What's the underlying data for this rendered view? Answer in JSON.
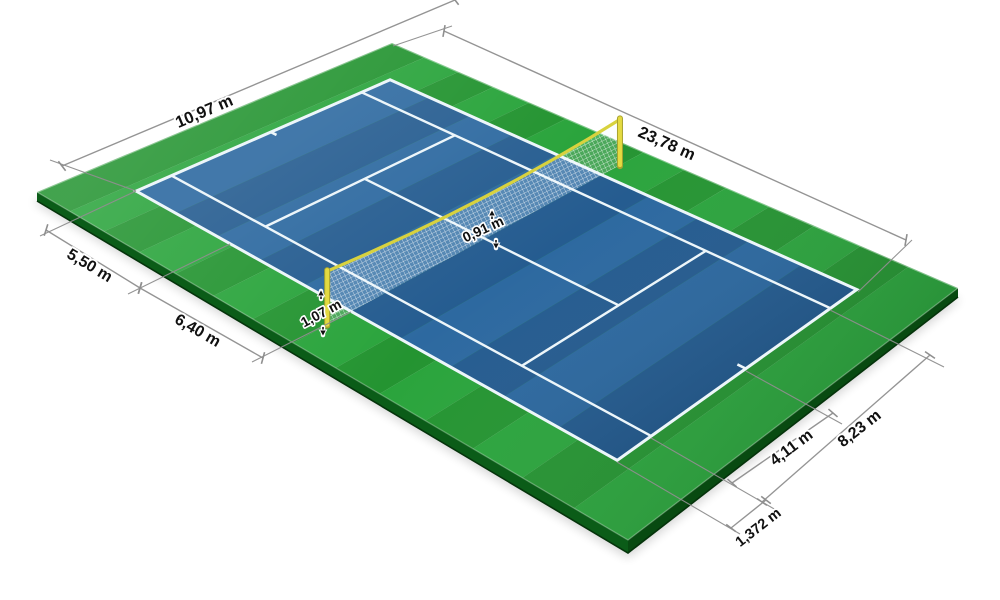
{
  "diagram": {
    "unit": "m",
    "labels": {
      "court_width": "10,97 m",
      "court_length": "23,78 m",
      "baseline_to_service_line": "5,50 m",
      "service_line_to_net": "6,40 m",
      "net_height_center": "0,91 m",
      "net_height_post": "1,07 m",
      "service_center_to_sideline": "4,11 m",
      "singles_court_width": "8,23 m",
      "doubles_alley_width": "1,372 m"
    },
    "colors": {
      "surround_green": "#249431",
      "surround_green_alt": "#2aa43c",
      "slab_edge_dark": "#0b5c18",
      "slab_edge_darker": "#084a11",
      "court_blue": "#2d69a0",
      "court_blue_alt": "#255c90",
      "line_white": "#edf6fa",
      "net_band_yellow": "#d8d23e",
      "net_post_yellow": "#e4da41",
      "net_post_shade": "#a8a22e",
      "dimension_line_gray": "#8f8f8f",
      "label_text": "#101010"
    }
  }
}
